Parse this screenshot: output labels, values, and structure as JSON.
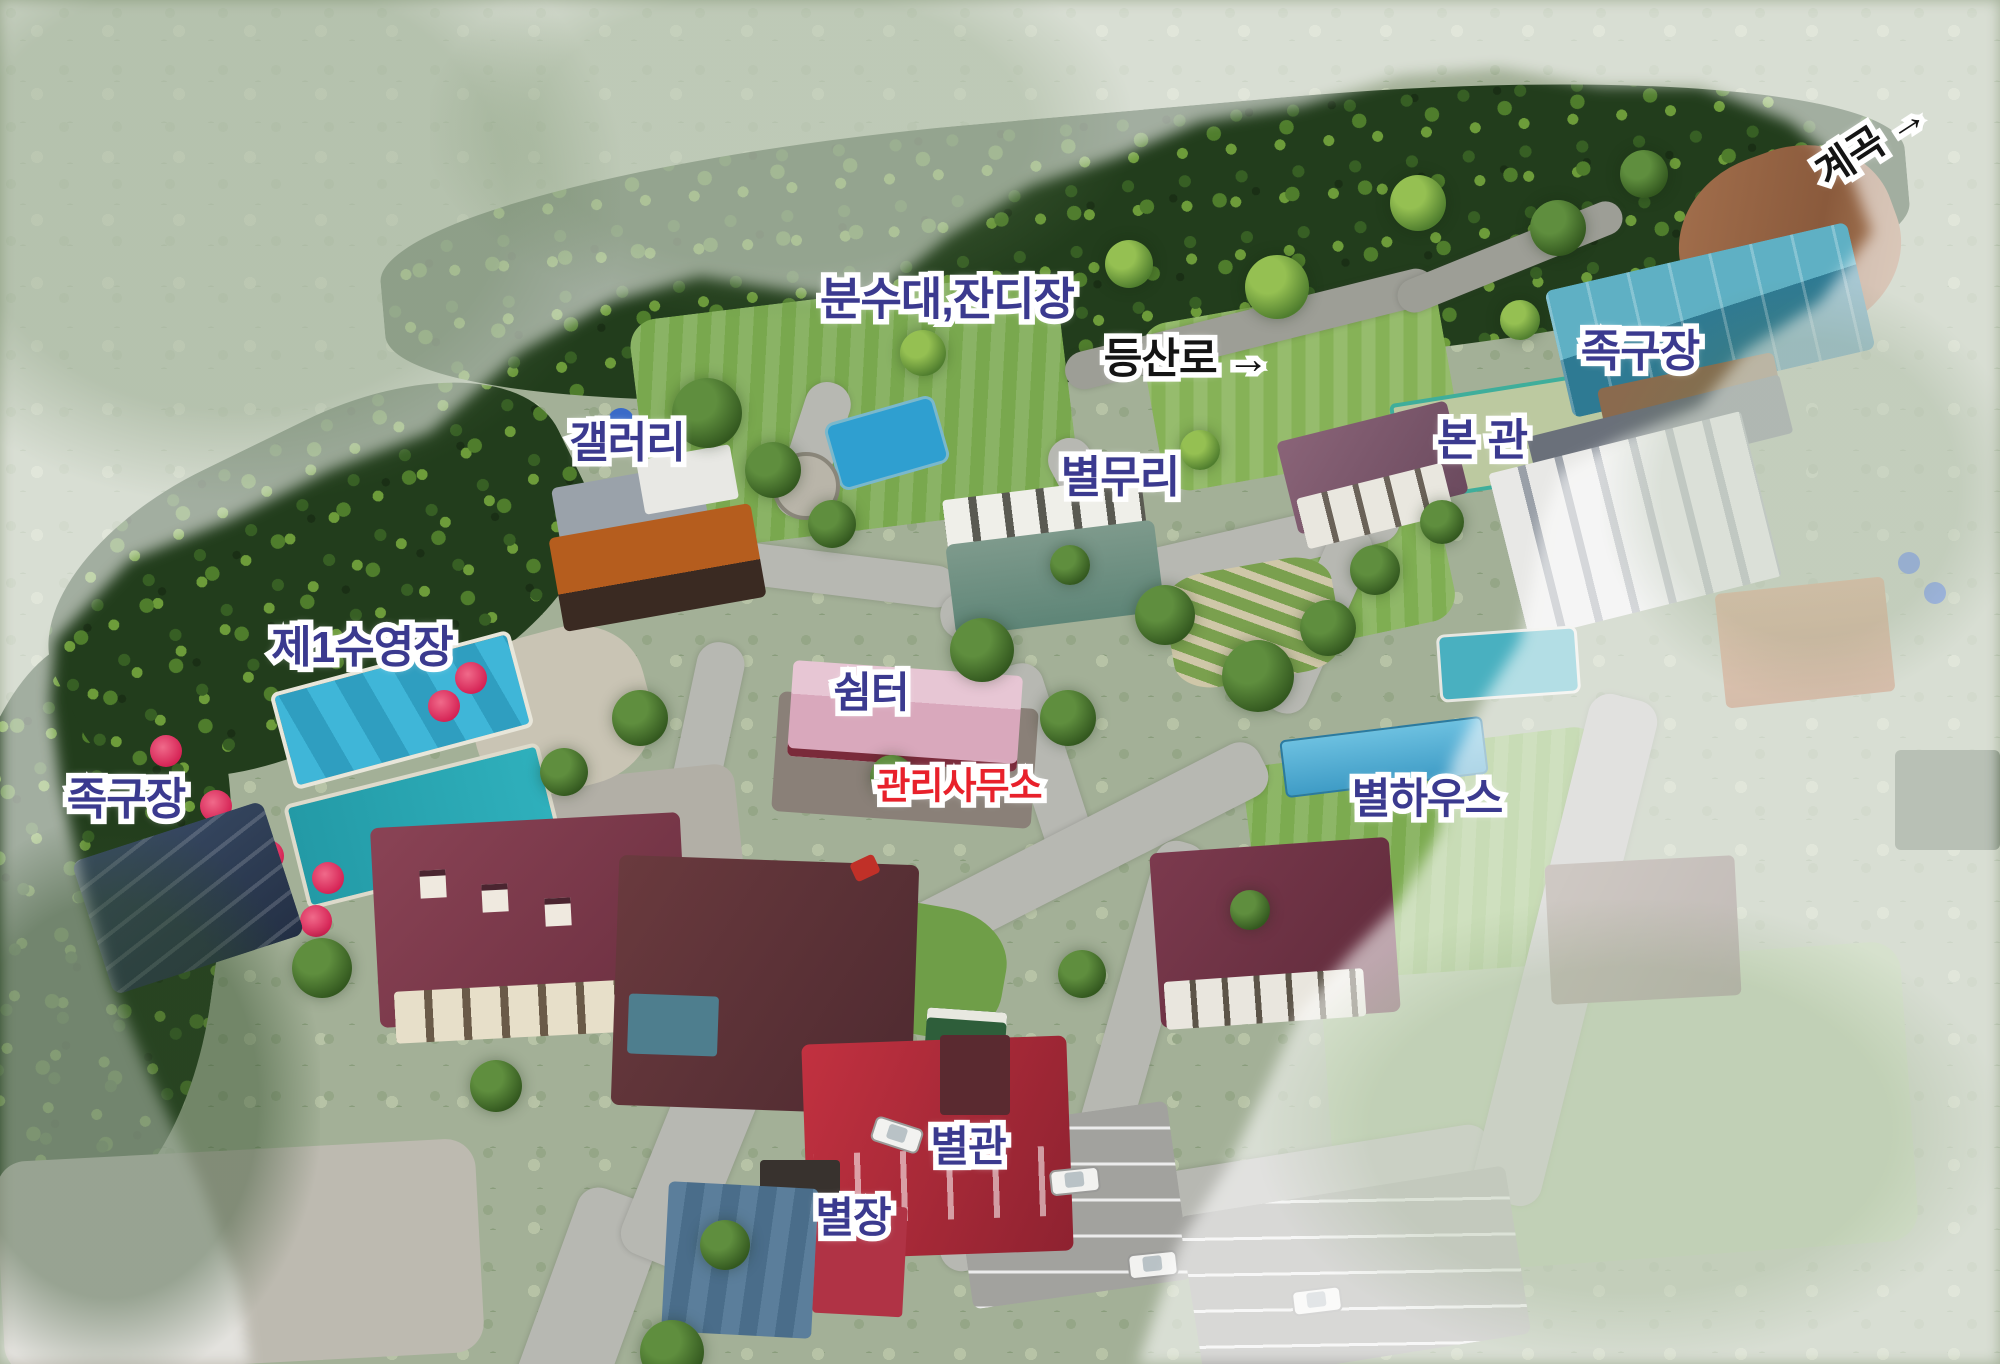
{
  "labels": {
    "fountain_lawn": {
      "text": "분수대,잔디장"
    },
    "hiking_trail": {
      "text": "등산로 →"
    },
    "valley": {
      "text": "계곡 →"
    },
    "jokgu_top": {
      "text": "족구장"
    },
    "main_hall": {
      "text": "본 관"
    },
    "byeolmuri": {
      "text": "별무리"
    },
    "gallery": {
      "text": "갤러리"
    },
    "pool1": {
      "text": "제1수영장"
    },
    "jokgu_left": {
      "text": "족구장"
    },
    "shelter": {
      "text": "쉼터"
    },
    "office": {
      "text": "관리사무소"
    },
    "byeol_house": {
      "text": "별하우스"
    },
    "annex": {
      "text": "별관"
    },
    "villa": {
      "text": "별장"
    }
  },
  "colors": {
    "label_navy": "#3b3a8f",
    "label_red": "#e8212b",
    "label_black": "#141414",
    "halo": "#ffffff"
  }
}
